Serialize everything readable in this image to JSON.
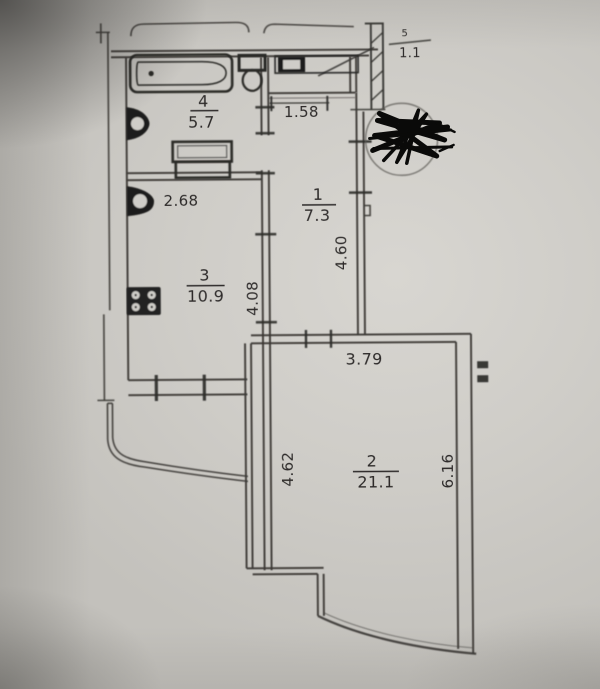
{
  "floor_plan": {
    "rooms": [
      {
        "number": "4",
        "area": "5.7"
      },
      {
        "number": "3",
        "area": "10.9"
      },
      {
        "number": "1",
        "area": "7.3"
      },
      {
        "number": "2",
        "area": "21.1"
      },
      {
        "number": "5",
        "area": "1.1"
      }
    ],
    "dimensions": {
      "bath_width": "2.68",
      "hall_top_width": "1.58",
      "hall_height": "4.60",
      "kitchen_height": "4.08",
      "living_top_width": "3.79",
      "living_left_height": "4.62",
      "living_right_height": "6.16"
    },
    "colors": {
      "paper": "#cbc9c4",
      "ink": "#3a3835",
      "redaction": "#0b0b0a"
    }
  }
}
